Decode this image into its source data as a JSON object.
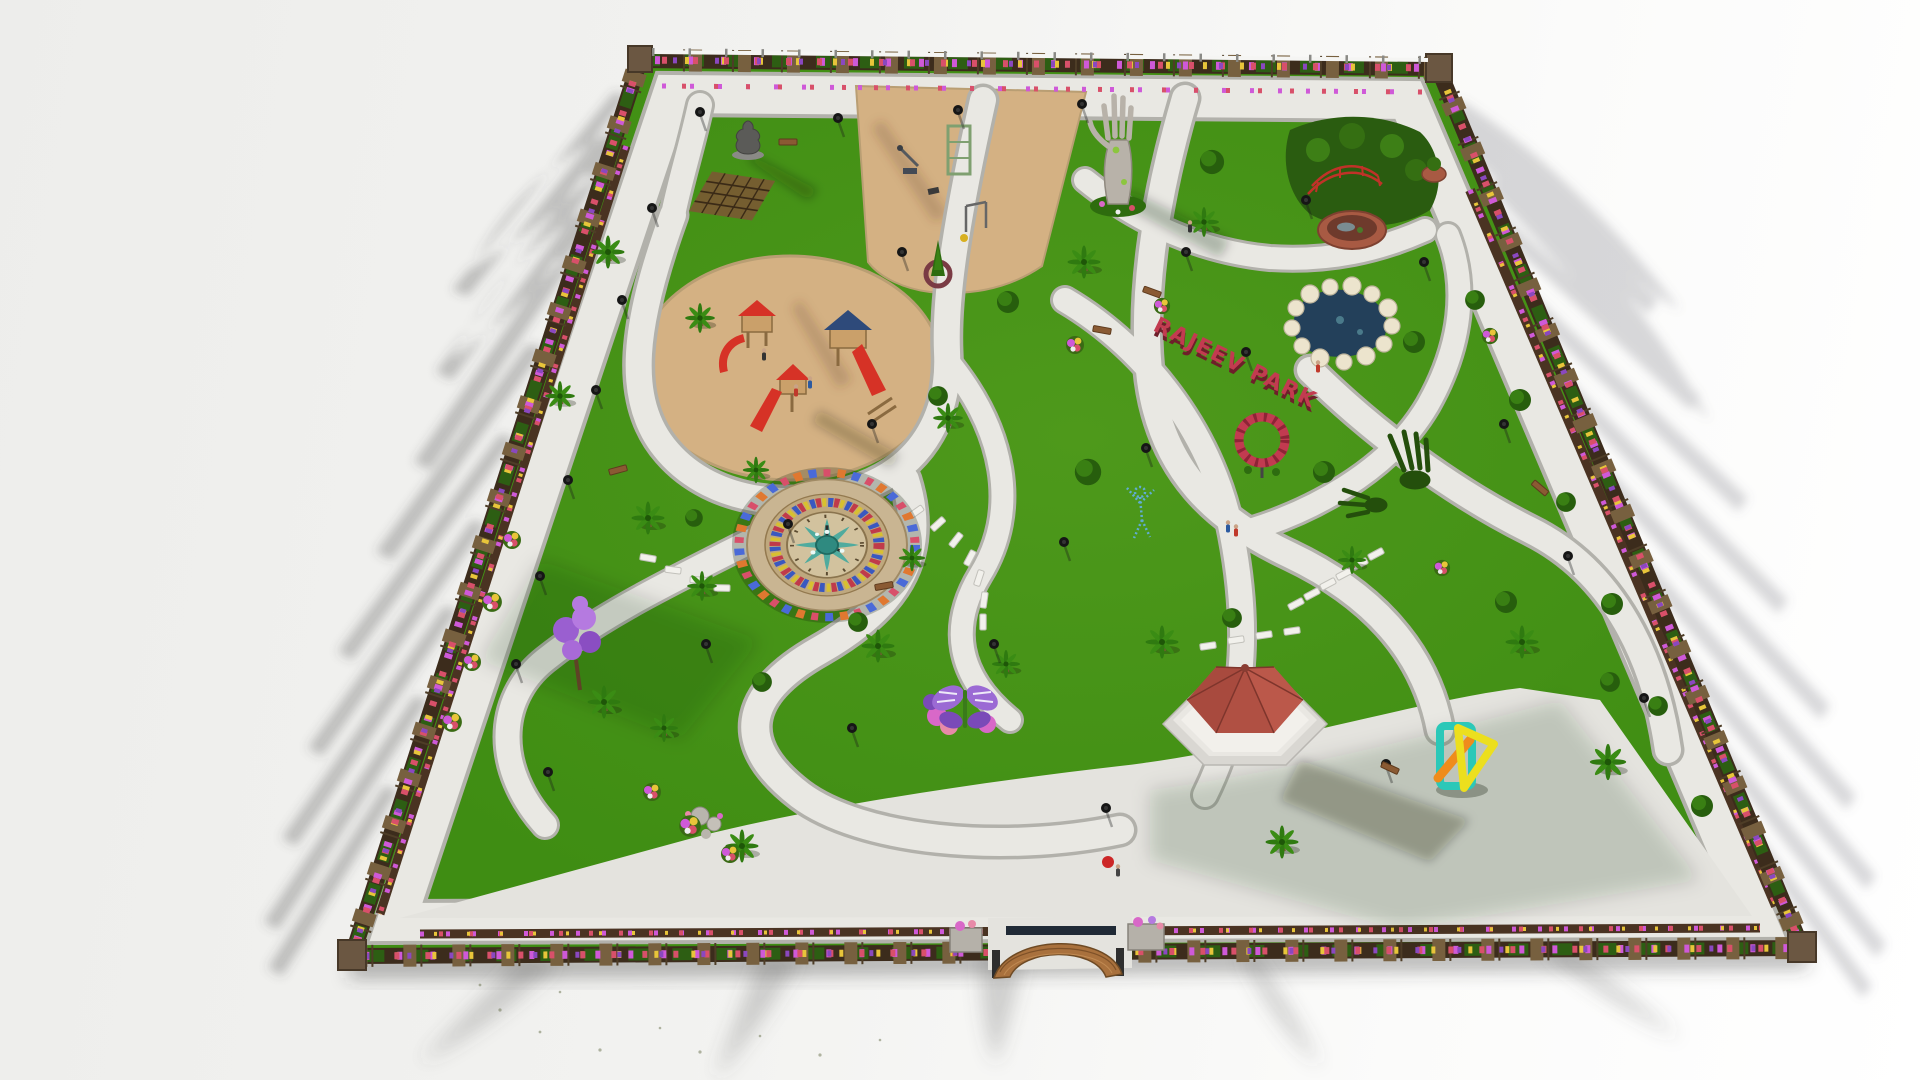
{
  "scene": {
    "description": "Aerial isometric 3D architectural render of a landscaped public park master plan on a white ground plane, long shadows cast outward from the perimeter",
    "render_style": "photorealistic 3D visualization",
    "background_color": "#f2f2f0"
  },
  "park": {
    "sign": {
      "text": "RAJEEV PARK",
      "color": "#c23b50"
    },
    "palette": {
      "grass": "#3f8d13",
      "grass_dark": "#2c650b",
      "path": "#e9e8e3",
      "path_edge": "#b2b1ab",
      "plaza": "#e4e3de",
      "sand": "#d4b183",
      "border_soil": "#3c2c1c",
      "pillar_brick": "#77603f",
      "water": "#23405a",
      "pond_rock": "#ece4cd",
      "gazebo_roof": "#b05043",
      "wood": "#a9713d",
      "stepping_stone": "#f2f1ec",
      "clock_stone": "#c9b592",
      "fountain_teal": "#3aa89e",
      "flower_magenta": "#cf59d8",
      "flower_yellow": "#e8c53a",
      "flower_red": "#d8506a",
      "sculpture_teal": "#2bc8b8",
      "sculpture_yellow": "#ecdf1e",
      "sculpture_orange": "#ef8c1c",
      "butterfly_purple": "#8a5ac8"
    },
    "features": [
      {
        "name": "perimeter-flower-wall",
        "label": "Brick-pillar perimeter wall with colorful flower beds and white top railing",
        "approx_position": "all four edges"
      },
      {
        "name": "buddha-statue",
        "label": "Seated Buddha statue",
        "approx_position": [
          748,
          138
        ]
      },
      {
        "name": "wooden-pergola",
        "label": "Wooden pergola trellis",
        "approx_position": [
          732,
          196
        ]
      },
      {
        "name": "fitness-area",
        "label": "Outdoor gym / fitness equipment on sand",
        "approx_position": [
          955,
          175
        ]
      },
      {
        "name": "giant-hand-sculpture",
        "label": "Giant concrete open-hand sculpture",
        "approx_position": [
          1118,
          150
        ]
      },
      {
        "name": "bridge-water-garden",
        "label": "Red footbridge over round brick water basin",
        "approx_position": [
          1352,
          205
        ]
      },
      {
        "name": "children-playground",
        "label": "Sand playground with wooden towers and red slides",
        "approx_position": [
          790,
          370
        ]
      },
      {
        "name": "park-name-sign",
        "label": "RAJEEV PARK red 3D letter sign on lawn",
        "approx_position": [
          1225,
          365
        ]
      },
      {
        "name": "rock-pond",
        "label": "Pond edged with white boulders",
        "approx_position": [
          1340,
          325
        ]
      },
      {
        "name": "floral-clock-fountain",
        "label": "Circular floral clock fountain with teal water jets",
        "approx_position": [
          827,
          545
        ]
      },
      {
        "name": "stepping-stone-arcs",
        "label": "White stepping-stone arcs",
        "approx_position": [
          940,
          550
        ]
      },
      {
        "name": "butterfly-flower-sculpture",
        "label": "Purple butterfly flower sculpture",
        "approx_position": [
          965,
          710
        ]
      },
      {
        "name": "wireframe-figure-sculpture",
        "label": "Blue wireframe human figure sculpture",
        "approx_position": [
          1140,
          512
        ]
      },
      {
        "name": "topiary-hand-sculptures",
        "label": "Green topiary hands emerging from lawn",
        "approx_position": [
          1398,
          470
        ]
      },
      {
        "name": "hexagonal-gazebo",
        "label": "Hexagonal gazebo with red shingle roof on white steps",
        "approx_position": [
          1245,
          720
        ]
      },
      {
        "name": "abstract-geometric-sculpture",
        "label": "Abstract teal/yellow/orange geometric sculpture",
        "approx_position": [
          1462,
          757
        ]
      },
      {
        "name": "rose-ring-sculpture",
        "label": "Red rose ring sculpture",
        "approx_position": [
          1262,
          442
        ]
      },
      {
        "name": "entrance-curved-bench",
        "label": "Curved wooden entrance wall bench at main gate",
        "approx_position": [
          1057,
          955
        ]
      },
      {
        "name": "purple-flower-tree",
        "label": "Tall purple flowering tree",
        "approx_position": [
          575,
          645
        ]
      },
      {
        "name": "walking-paths",
        "label": "Winding granite walking paths",
        "approx_position": "throughout"
      },
      {
        "name": "palm-trees",
        "label": "Palm trees",
        "approx_position": "throughout"
      },
      {
        "name": "street-lamps",
        "label": "Black pole street lamps",
        "approx_position": "along paths"
      },
      {
        "name": "park-benches",
        "label": "Wooden park benches",
        "approx_position": "along paths"
      },
      {
        "name": "visitors",
        "label": "Small human figures walking",
        "approx_position": "on paths and playground"
      }
    ]
  }
}
